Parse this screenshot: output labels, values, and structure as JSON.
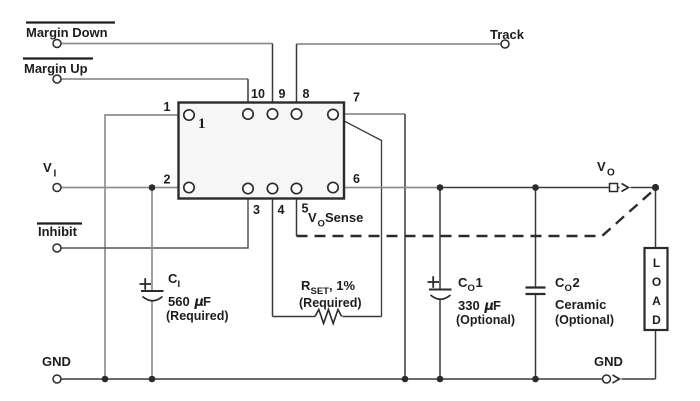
{
  "colors": {
    "wire_gray": "#8f8f8f",
    "wire_dark": "#3a3a3a",
    "ink_black": "#1d1d1d",
    "module_fill": "#f6f6f6",
    "background": "#ffffff"
  },
  "terminals": {
    "margin_down": {
      "label": "Margin Down",
      "active_low": true
    },
    "margin_up": {
      "label": "Margin Up",
      "active_low": true
    },
    "track": {
      "label": "Track"
    },
    "v_in": {
      "base": "V",
      "sub": "I"
    },
    "inhibit": {
      "label": "Inhibit",
      "active_low": true
    },
    "gnd_left": {
      "label": "GND"
    },
    "v_out": {
      "base": "V",
      "sub": "O"
    },
    "gnd_right": {
      "label": "GND"
    }
  },
  "module": {
    "pin_numbers": {
      "p1": "1",
      "p2": "2",
      "p3": "3",
      "p4": "4",
      "p5": "5",
      "p6": "6",
      "p7": "7",
      "p8": "8",
      "p9": "9",
      "p10": "10"
    },
    "pin1_inside_marker": "1"
  },
  "nets": {
    "vo_sense": {
      "base": "V",
      "sub": "O",
      "rest": "Sense"
    }
  },
  "components": {
    "c_in": {
      "ref_base": "C",
      "ref_sub": "I",
      "polarity": "+",
      "value_num": "560",
      "value_mu": "μ",
      "value_unit": "F",
      "note": "(Required)"
    },
    "r_set": {
      "ref_base": "R",
      "ref_sub": "SET",
      "ref_suffix": ", 1%",
      "note": "(Required)"
    },
    "c_out1": {
      "ref_base": "C",
      "ref_sub": "O",
      "ref_index": "1",
      "polarity": "+",
      "value_num": "330",
      "value_mu": "μ",
      "value_unit": "F",
      "note": "(Optional)"
    },
    "c_out2": {
      "ref_base": "C",
      "ref_sub": "O",
      "ref_index": "2",
      "value": "Ceramic",
      "note": "(Optional)"
    },
    "load": {
      "letters": [
        "L",
        "O",
        "A",
        "D"
      ]
    }
  }
}
